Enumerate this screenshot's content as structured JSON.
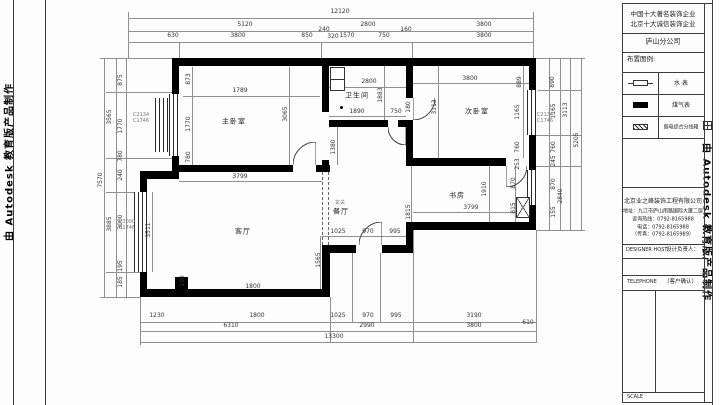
{
  "watermarks": {
    "left": "由 Autodesk 教育版产品制作",
    "right": "由 Autodesk 教育版产品制作"
  },
  "title_block": {
    "header_line1": "中国十大著名装饰企业",
    "header_line2": "北京十大诚信装饰企业",
    "branch": "庐山分公司",
    "legend_title": "布置图例:",
    "legend_labels": [
      "水 表",
      "煤气表",
      "弱电综合分线箱"
    ],
    "company_lines": [
      "北京业之峰装饰工程有限公司",
      "地址：九江市庐山南路国际大厦二层",
      "咨询热线：0792-8165988",
      "电话：0792-8165988",
      "（传真：0792-8165989）"
    ],
    "designer_en": "DESIGNER HOST",
    "designer_cn": "设计负责人：",
    "client_en": "TELEPHONE",
    "client_cn": "（客户确认）",
    "scale_label": "SCALE"
  },
  "frame_lines": [
    [
      13,
      0,
      1,
      405
    ],
    [
      45,
      0,
      1,
      405
    ],
    [
      622,
      3,
      1,
      400
    ],
    [
      704,
      3,
      1,
      400
    ],
    [
      712,
      0,
      1,
      405
    ],
    [
      622,
      3,
      90,
      1
    ],
    [
      622,
      33,
      82,
      1
    ],
    [
      622,
      52,
      82,
      1
    ],
    [
      622,
      72,
      82,
      1
    ],
    [
      622,
      94,
      82,
      1
    ],
    [
      622,
      116,
      82,
      1
    ],
    [
      622,
      138,
      82,
      1
    ],
    [
      622,
      187,
      82,
      1
    ],
    [
      622,
      244,
      82,
      1
    ],
    [
      622,
      258,
      82,
      1
    ],
    [
      622,
      275,
      82,
      1
    ],
    [
      622,
      290,
      82,
      1
    ],
    [
      622,
      392,
      82,
      1
    ],
    [
      622,
      402,
      90,
      1
    ],
    [
      655,
      290,
      1,
      102
    ],
    [
      658,
      72,
      1,
      66
    ],
    [
      628,
      83,
      5,
      1
    ],
    [
      648,
      83,
      5,
      1
    ]
  ],
  "plan": {
    "rooms": [
      [
        "主卧室",
        234,
        122
      ],
      [
        "卫生间",
        357,
        96
      ],
      [
        "次卧室",
        477,
        112
      ],
      [
        "书房",
        457,
        196
      ],
      [
        "客厅",
        243,
        232
      ],
      [
        "餐厅",
        341,
        212
      ]
    ],
    "dims": [
      [
        "12120",
        340,
        12,
        0
      ],
      [
        "5120",
        245,
        25,
        0
      ],
      [
        "2800",
        368,
        25,
        0
      ],
      [
        "3800",
        484,
        25,
        0
      ],
      [
        "630",
        173,
        36,
        0
      ],
      [
        "3800",
        238,
        36,
        0
      ],
      [
        "850",
        307,
        36,
        0
      ],
      [
        "240",
        324,
        30,
        0
      ],
      [
        "320",
        333,
        37,
        0
      ],
      [
        "1570",
        347,
        36,
        0
      ],
      [
        "750",
        384,
        36,
        0
      ],
      [
        "160",
        406,
        30,
        0
      ],
      [
        "3800",
        484,
        36,
        0
      ],
      [
        "1230",
        157,
        316,
        0
      ],
      [
        "1800",
        257,
        316,
        0
      ],
      [
        "1025",
        338,
        316,
        0
      ],
      [
        "970",
        368,
        316,
        0
      ],
      [
        "995",
        396,
        316,
        0
      ],
      [
        "3190",
        474,
        316,
        0
      ],
      [
        "6310",
        231,
        326,
        0
      ],
      [
        "2990",
        367,
        326,
        0
      ],
      [
        "3800",
        474,
        326,
        0
      ],
      [
        "610",
        528,
        323,
        0
      ],
      [
        "13300",
        334,
        337,
        0
      ],
      [
        "7570",
        101,
        180,
        1
      ],
      [
        "3565",
        110,
        117,
        1
      ],
      [
        "3885",
        110,
        224,
        1
      ],
      [
        "875",
        121,
        80,
        1
      ],
      [
        "1770",
        121,
        126,
        1
      ],
      [
        "780",
        121,
        156,
        1
      ],
      [
        "240",
        121,
        175,
        1
      ],
      [
        "3000",
        121,
        222,
        1
      ],
      [
        "195",
        121,
        266,
        1
      ],
      [
        "185",
        121,
        282,
        1
      ],
      [
        "890",
        553,
        82,
        1
      ],
      [
        "1165",
        554,
        111,
        1
      ],
      [
        "3113",
        566,
        110,
        1
      ],
      [
        "760",
        554,
        147,
        1
      ],
      [
        "245",
        554,
        161,
        1
      ],
      [
        "870",
        554,
        184,
        1
      ],
      [
        "2840",
        561,
        196,
        1
      ],
      [
        "155",
        554,
        212,
        1
      ],
      [
        "5205",
        577,
        140,
        1
      ],
      [
        "1789",
        240,
        91,
        0
      ],
      [
        "3065",
        286,
        114,
        1
      ],
      [
        "873",
        189,
        79,
        1
      ],
      [
        "1770",
        189,
        124,
        1
      ],
      [
        "780",
        189,
        157,
        1
      ],
      [
        "3799",
        240,
        177,
        0
      ],
      [
        "2800",
        369,
        82,
        0
      ],
      [
        "1883",
        381,
        95,
        1
      ],
      [
        "1890",
        357,
        112,
        0
      ],
      [
        "750",
        396,
        112,
        0
      ],
      [
        "180",
        409,
        107,
        1
      ],
      [
        "1380",
        334,
        147,
        1
      ],
      [
        "3800",
        470,
        79,
        0
      ],
      [
        "3113",
        435,
        107,
        1
      ],
      [
        "889",
        520,
        82,
        1
      ],
      [
        "1165",
        518,
        112,
        1
      ],
      [
        "760",
        518,
        147,
        1
      ],
      [
        "253",
        518,
        164,
        1
      ],
      [
        "870",
        514,
        183,
        1
      ],
      [
        "815",
        514,
        208,
        1
      ],
      [
        "1910",
        485,
        189,
        1
      ],
      [
        "3799",
        471,
        208,
        0
      ],
      [
        "1815",
        409,
        212,
        1
      ],
      [
        "3511",
        149,
        230,
        1
      ],
      [
        "1025",
        338,
        232,
        0
      ],
      [
        "970",
        368,
        232,
        0
      ],
      [
        "995",
        395,
        232,
        0
      ],
      [
        "1565",
        319,
        260,
        1
      ],
      [
        "1800",
        253,
        287,
        0
      ],
      [
        "190",
        183,
        281,
        1
      ]
    ],
    "annotations": [
      [
        "C2134",
        141,
        115
      ],
      [
        "C1746",
        141,
        121
      ],
      [
        "C3000",
        127,
        222
      ],
      [
        "C1746",
        127,
        228
      ],
      [
        "C2134",
        545,
        115
      ],
      [
        "C1746",
        545,
        121
      ],
      [
        "玄关",
        340,
        203
      ]
    ],
    "walls": [
      [
        172,
        58,
        364,
        8
      ],
      [
        172,
        66,
        7,
        29
      ],
      [
        172,
        155,
        7,
        17
      ],
      [
        140,
        171,
        39,
        8
      ],
      [
        140,
        179,
        7,
        13
      ],
      [
        140,
        272,
        7,
        25
      ],
      [
        140,
        289,
        190,
        8
      ],
      [
        322,
        245,
        8,
        52
      ],
      [
        330,
        245,
        26,
        8
      ],
      [
        382,
        245,
        31,
        8
      ],
      [
        406,
        222,
        7,
        31
      ],
      [
        406,
        222,
        130,
        8
      ],
      [
        529,
        66,
        7,
        24
      ],
      [
        529,
        135,
        7,
        35
      ],
      [
        529,
        205,
        7,
        25
      ],
      [
        413,
        158,
        93,
        8
      ],
      [
        406,
        66,
        7,
        32
      ],
      [
        406,
        120,
        7,
        46
      ],
      [
        322,
        58,
        7,
        54
      ],
      [
        322,
        160,
        7,
        12
      ],
      [
        329,
        120,
        59,
        7
      ],
      [
        398,
        120,
        8,
        7
      ],
      [
        172,
        165,
        121,
        7
      ],
      [
        316,
        165,
        14,
        7
      ],
      [
        175,
        277,
        13,
        13
      ]
    ],
    "windows": [
      [
        169,
        94,
        11,
        62
      ],
      [
        155,
        98,
        13,
        54
      ],
      [
        134,
        192,
        15,
        80
      ],
      [
        527,
        90,
        11,
        45
      ],
      [
        527,
        170,
        11,
        35
      ]
    ],
    "doors": [
      [
        293,
        142,
        23,
        ""
      ],
      [
        388,
        127,
        18,
        "scaleY(-1)"
      ],
      [
        506,
        166,
        21,
        "rotate(180deg)"
      ],
      [
        413,
        98,
        22,
        "rotate(180deg)"
      ],
      [
        359,
        222,
        23,
        ""
      ]
    ],
    "dashes": [
      [
        322,
        172,
        73
      ],
      [
        328,
        172,
        73
      ]
    ],
    "fixtures": [
      [
        330,
        67,
        15,
        24,
        "cells"
      ],
      [
        516,
        197,
        14,
        21,
        "cross"
      ],
      [
        340,
        106,
        3,
        3,
        "dot"
      ]
    ],
    "dimlines": [
      [
        128,
        18,
        405,
        1
      ],
      [
        128,
        31,
        405,
        1
      ],
      [
        128,
        42,
        405,
        1
      ],
      [
        140,
        322,
        396,
        1
      ],
      [
        140,
        331,
        396,
        1
      ],
      [
        140,
        342,
        396,
        1
      ],
      [
        104,
        58,
        1,
        239
      ],
      [
        116,
        58,
        1,
        239
      ],
      [
        126,
        58,
        1,
        239
      ],
      [
        549,
        58,
        1,
        173
      ],
      [
        560,
        58,
        1,
        173
      ],
      [
        570,
        58,
        1,
        173
      ],
      [
        581,
        58,
        1,
        173
      ],
      [
        183,
        96,
        137,
        1
      ],
      [
        289,
        67,
        1,
        98
      ],
      [
        192,
        67,
        1,
        98
      ],
      [
        179,
        181,
        143,
        1
      ],
      [
        413,
        83,
        116,
        1
      ],
      [
        438,
        66,
        1,
        92
      ],
      [
        523,
        66,
        1,
        92
      ],
      [
        329,
        87,
        77,
        1
      ],
      [
        329,
        116,
        77,
        1
      ],
      [
        384,
        66,
        1,
        54
      ],
      [
        337,
        127,
        1,
        38
      ],
      [
        322,
        236,
        84,
        1
      ],
      [
        320,
        236,
        1,
        53
      ],
      [
        489,
        166,
        1,
        56
      ],
      [
        413,
        212,
        116,
        1
      ],
      [
        411,
        166,
        1,
        79
      ],
      [
        515,
        166,
        1,
        56
      ],
      [
        152,
        192,
        1,
        80
      ],
      [
        128,
        12,
        1,
        46
      ],
      [
        533,
        12,
        1,
        46
      ],
      [
        179,
        42,
        1,
        16
      ],
      [
        321,
        42,
        1,
        16
      ],
      [
        412,
        42,
        1,
        16
      ],
      [
        140,
        297,
        1,
        48
      ],
      [
        330,
        297,
        1,
        45
      ],
      [
        352,
        253,
        1,
        70
      ],
      [
        380,
        253,
        1,
        70
      ],
      [
        413,
        230,
        1,
        113
      ],
      [
        536,
        230,
        1,
        113
      ],
      [
        536,
        58,
        49,
        1
      ],
      [
        536,
        90,
        45,
        1
      ],
      [
        536,
        135,
        45,
        1
      ],
      [
        536,
        166,
        45,
        1
      ],
      [
        536,
        230,
        49,
        1
      ],
      [
        100,
        58,
        72,
        1
      ],
      [
        106,
        92,
        66,
        1
      ],
      [
        106,
        158,
        66,
        1
      ],
      [
        100,
        297,
        40,
        1
      ],
      [
        106,
        272,
        34,
        1
      ],
      [
        106,
        192,
        34,
        1
      ]
    ]
  }
}
